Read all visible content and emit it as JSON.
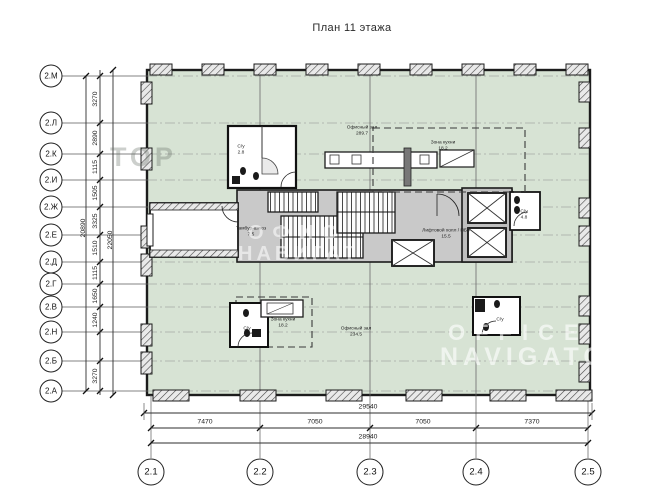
{
  "title": "План 11 этажа",
  "colors": {
    "plan_fill": "#d7e3d4",
    "wall": "#1c1c1c",
    "core_fill": "#c9c9c9"
  },
  "row_axes": [
    {
      "label": "2.М",
      "y": 76
    },
    {
      "label": "2.Л",
      "y": 123
    },
    {
      "label": "2.К",
      "y": 154
    },
    {
      "label": "2.И",
      "y": 180
    },
    {
      "label": "2.Ж",
      "y": 207
    },
    {
      "label": "2.Е",
      "y": 235
    },
    {
      "label": "2.Д",
      "y": 262
    },
    {
      "label": "2.Г",
      "y": 284
    },
    {
      "label": "2.В",
      "y": 307
    },
    {
      "label": "2.Н",
      "y": 332
    },
    {
      "label": "2.Б",
      "y": 361
    },
    {
      "label": "2.А",
      "y": 391
    }
  ],
  "row_dims": [
    {
      "text": "3270",
      "y": 99
    },
    {
      "text": "2890",
      "y": 138
    },
    {
      "text": "1115",
      "y": 167
    },
    {
      "text": "1505",
      "y": 193
    },
    {
      "text": "3325",
      "y": 221
    },
    {
      "text": "1510",
      "y": 248
    },
    {
      "text": "1115",
      "y": 273
    },
    {
      "text": "1650",
      "y": 296
    },
    {
      "text": "1240",
      "y": 320
    },
    {
      "text": "3270",
      "y": 376
    }
  ],
  "row_totals": [
    {
      "text": "20890",
      "x": 83,
      "y": 228
    },
    {
      "text": "22050",
      "x": 110,
      "y": 240
    }
  ],
  "col_axes": [
    {
      "label": "2.1",
      "x": 151
    },
    {
      "label": "2.2",
      "x": 260
    },
    {
      "label": "2.3",
      "x": 370
    },
    {
      "label": "2.4",
      "x": 476
    },
    {
      "label": "2.5",
      "x": 588
    }
  ],
  "col_dims": [
    {
      "text": "7470",
      "x": 205
    },
    {
      "text": "7050",
      "x": 315
    },
    {
      "text": "7050",
      "x": 423
    },
    {
      "text": "7370",
      "x": 532
    }
  ],
  "col_totals": [
    {
      "text": "29540",
      "y": 411
    },
    {
      "text": "28940",
      "y": 441
    }
  ],
  "rooms": [
    {
      "name": "Офисный зал",
      "area": "289.7",
      "x": 362,
      "y": 130
    },
    {
      "name": "Зона кухни",
      "area": "18.2",
      "x": 443,
      "y": 145
    },
    {
      "name": "С/у",
      "area": "2.8",
      "x": 241,
      "y": 149
    },
    {
      "name": "Тамбур-шлюз",
      "area": "7.5",
      "x": 251,
      "y": 231
    },
    {
      "name": "Лифтовой холл / ПБЗ",
      "area": "15.5",
      "x": 446,
      "y": 233
    },
    {
      "name": "С/у",
      "area": "4.8",
      "x": 524,
      "y": 214
    },
    {
      "name": "Зона кухни",
      "area": "18.2",
      "x": 283,
      "y": 322
    },
    {
      "name": "С/у",
      "area": "5.4",
      "x": 247,
      "y": 331
    },
    {
      "name": "С/у",
      "area": "",
      "x": 500,
      "y": 319
    },
    {
      "name": "Офисный зал",
      "area": "234.5",
      "x": 356,
      "y": 331
    }
  ],
  "watermarks": {
    "w1": "ТОР",
    "w2a": "ОФИС",
    "w2b": "НАВИГАТ",
    "w3a": "OFFICE",
    "w3b": "NAVIGATO"
  }
}
